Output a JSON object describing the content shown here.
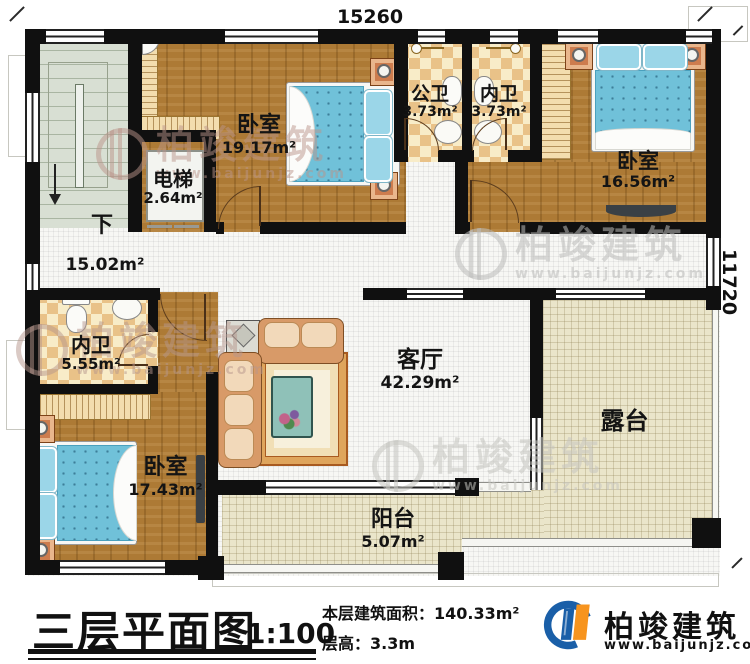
{
  "dimensions": {
    "top": "15260",
    "right": "11720"
  },
  "stairs": {
    "direction": "下"
  },
  "rooms": {
    "bedroom1": {
      "label": "卧室",
      "area": "19.17m²"
    },
    "elevator": {
      "label": "电梯",
      "area": "2.64m²"
    },
    "public_bath": {
      "label": "公卫",
      "area": "3.73m²"
    },
    "ensuite_top": {
      "label": "内卫",
      "area": "3.73m²"
    },
    "bedroom2": {
      "label": "卧室",
      "area": "16.56m²"
    },
    "hall": {
      "area": "15.02m²"
    },
    "ensuite_left": {
      "label": "内卫",
      "area": "5.55m²"
    },
    "bedroom3": {
      "label": "卧室",
      "area": "17.43m²"
    },
    "living": {
      "label": "客厅",
      "area": "42.29m²"
    },
    "terrace": {
      "label": "露台"
    },
    "balcony": {
      "label": "阳台",
      "area": "5.07m²"
    }
  },
  "title_block": {
    "title": "三层平面图",
    "scale": "1:100",
    "floor_area": "本层建筑面积：140.33m²",
    "floor_height": "层高：3.3m"
  },
  "brand": {
    "name": "柏竣建筑",
    "website": "www.baijunjz.com"
  },
  "watermark": {
    "name": "柏竣建筑",
    "website": "www.baijunjz.com"
  }
}
